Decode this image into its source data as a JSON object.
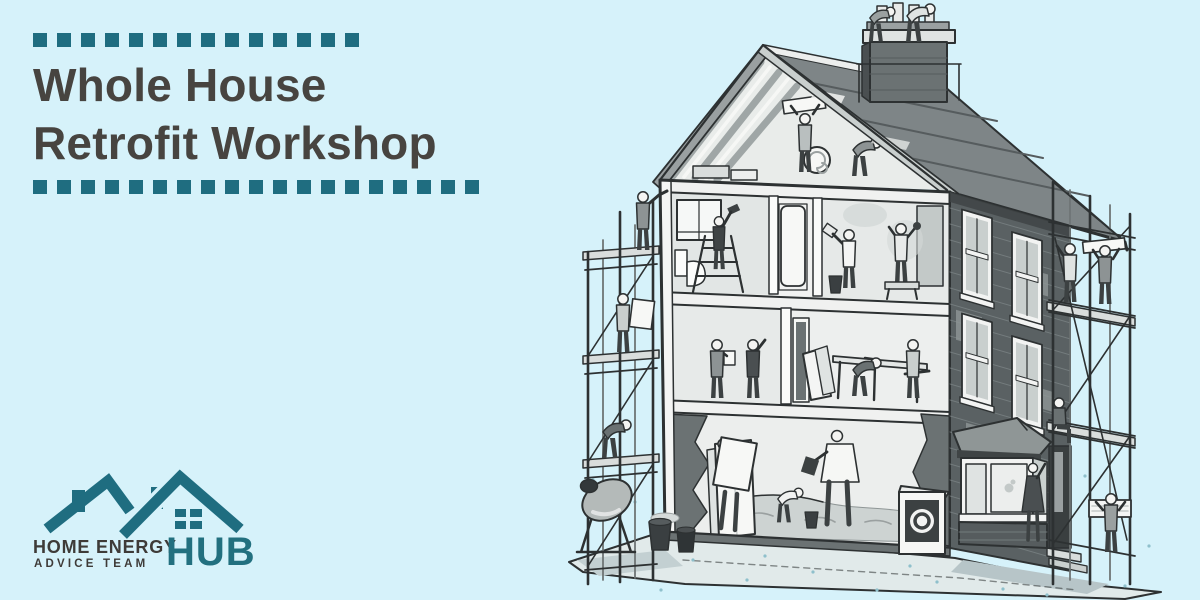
{
  "banner": {
    "title": {
      "line1": "Whole House",
      "line2": "Retrofit Workshop"
    },
    "decor": {
      "top_squares": 14,
      "bottom_squares": 19
    }
  },
  "logo": {
    "line1": "HOME ENERGY",
    "line2": "ADVICE TEAM",
    "hub": "HUB"
  },
  "illustration": {
    "name": "whole-house-retrofit-cutaway",
    "description": "Grayscale cutaway of a three-storey house under retrofit: workers insulating the roof and chimney, plastering and drilling on the top floor, sawing at a workbench, laying floor insulation on the ground floor, scaffolding on both sides, cement mixer, bay window and air-source heat pump"
  },
  "colors": {
    "background": "#d6f2fa",
    "accent_teal": "#1f6d80",
    "title_text": "#474440",
    "logo_text": "#3e3b38",
    "hub_teal": "#22707f",
    "illustration_ink": "#2d3132"
  }
}
